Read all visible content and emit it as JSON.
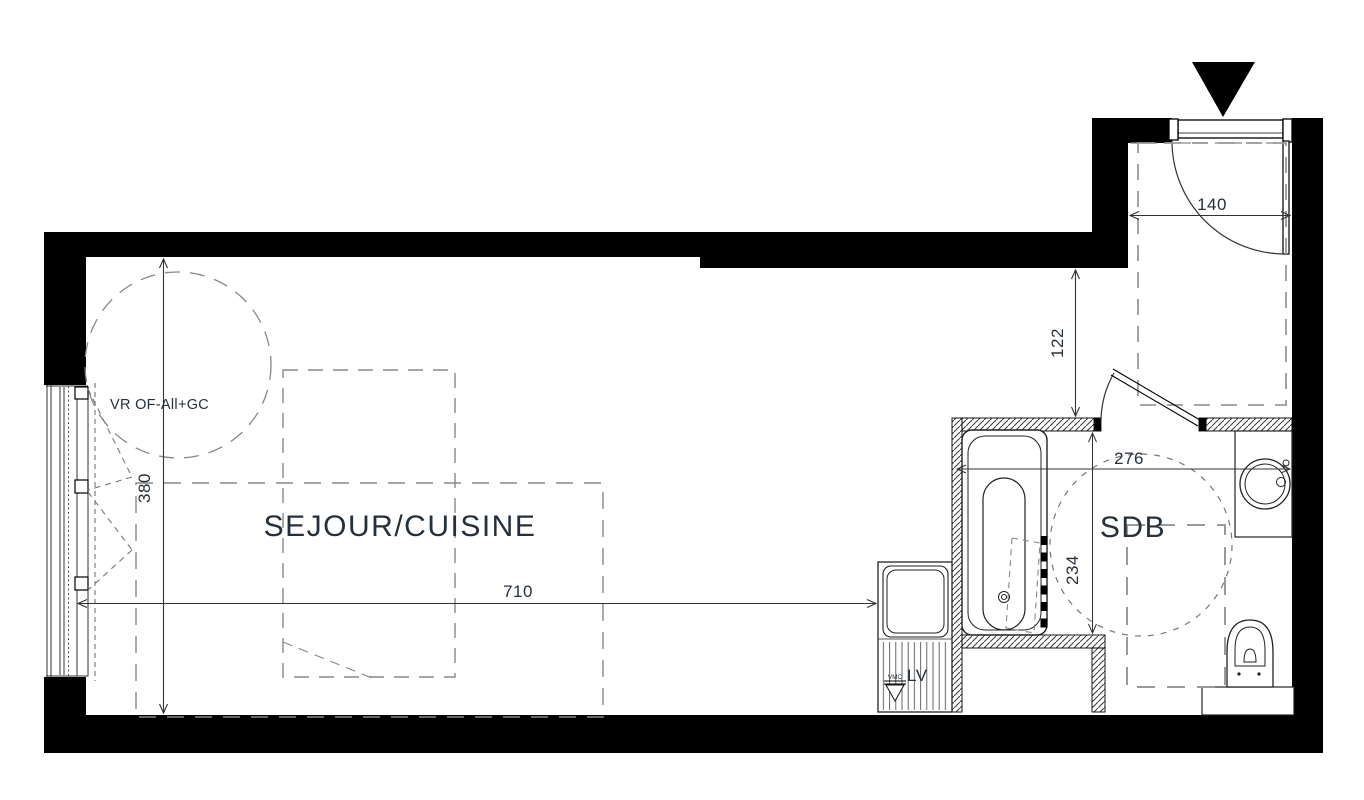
{
  "drawing_type": "apartment floor plan",
  "colors": {
    "wall": "#000000",
    "line": "#222222",
    "dash_gray": "#8a8a8a",
    "text": "#26303b",
    "background": "#ffffff"
  },
  "rooms": {
    "main": {
      "label": "SEJOUR/CUISINE"
    },
    "bath": {
      "label": "SDB"
    }
  },
  "labels": {
    "window_spec": "VR OF-All+GC",
    "dishwasher": "LV",
    "vent": "VMC"
  },
  "dims": {
    "entry_width": "140",
    "entry_depth": "122",
    "bath_width": "276",
    "bath_depth": "234",
    "room_width": "710",
    "room_depth": "380"
  }
}
